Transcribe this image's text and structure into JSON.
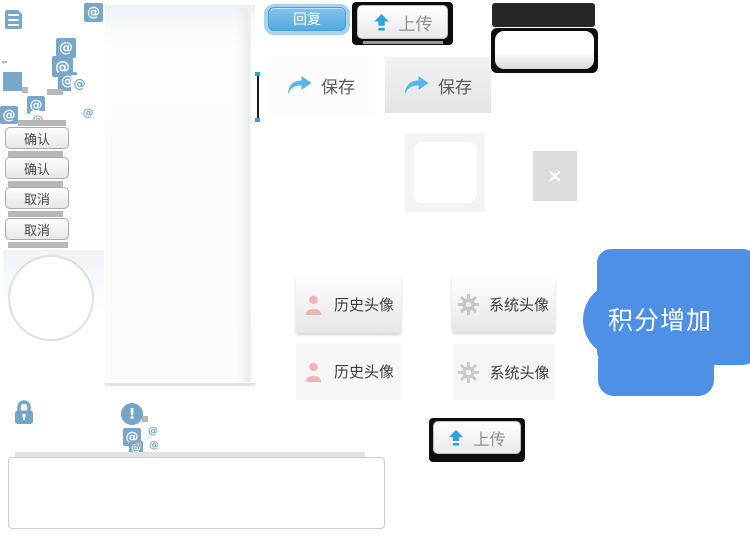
{
  "glyphs": {
    "at": "@",
    "exclamation": "!",
    "close": "×"
  },
  "buttons": {
    "reply": "回复",
    "upload": "上传",
    "save": "保存",
    "confirm": "确认",
    "cancel": "取消",
    "history_avatar": "历史头像",
    "system_avatar": "系统头像"
  },
  "bubble": {
    "label": "积分增加"
  },
  "colors": {
    "icon_steel_blue": "#78a7c9",
    "bubble_blue": "#4e90e5",
    "reply_blue": "#51a9e1",
    "reply_halo_blue": "#a6d2ef",
    "upload_arrow_blue": "#2ba3e0",
    "save_arrow_blue": "#56b7e6",
    "person_pink": "#f2b3b8",
    "gear_gray": "#c6c6c6",
    "frame_black": "#0d0d0d",
    "shadow_gray": "#b7b7b7"
  }
}
